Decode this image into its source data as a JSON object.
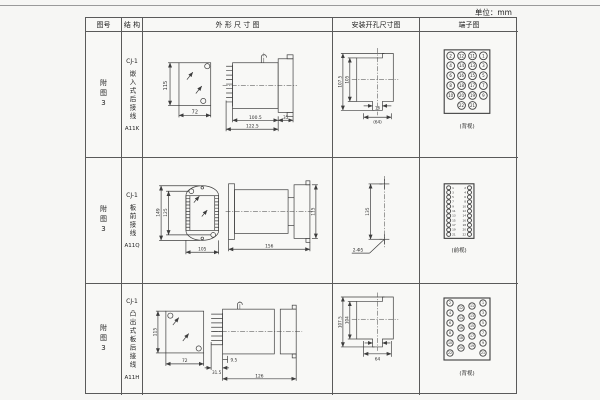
{
  "page": {
    "unit_label": "单位：mm"
  },
  "table": {
    "headers": {
      "fig_no": "图号",
      "structure": "结 构",
      "outline": "外 形 尺 寸 图",
      "mounting": "安装开孔尺寸图",
      "terminal": "端子图"
    }
  },
  "rows": [
    {
      "fig_no": "附图3",
      "model": "CJ-1",
      "mount_type": "嵌入式后接线",
      "code": "A11K",
      "outline": {
        "front_h": "115",
        "front_w": "72",
        "len1": "100.5",
        "len2": "122.5",
        "len3": "35"
      },
      "mounting": {
        "v_outer": "107.5",
        "v_inner": "105",
        "slot_w": "16",
        "span": "(64)"
      },
      "terminal": {
        "view": "(背视)",
        "rows": [
          [
            2,
            12,
            11,
            1
          ],
          [
            4,
            14,
            13,
            3
          ],
          [
            6,
            16,
            15,
            5
          ],
          [
            8,
            18,
            17,
            7
          ],
          [
            10,
            20,
            19,
            9
          ],
          [
            22,
            21
          ]
        ]
      }
    },
    {
      "fig_no": "附图3",
      "model": "CJ-1",
      "mount_type": "板前接线",
      "code": "A11Q",
      "outline": {
        "front_h_outer": "149",
        "front_h_inner": "125",
        "front_w": "105",
        "side_len": "156",
        "side_h": "115"
      },
      "mounting": {
        "hole_spacing": "135",
        "hole_note": "2-Φ5"
      },
      "terminal": {
        "view": "(前视)",
        "pairs": [
          [
            1,
            2
          ],
          [
            3,
            4
          ],
          [
            5,
            6
          ],
          [
            7,
            8
          ],
          [
            9,
            10
          ],
          [
            11,
            12
          ],
          [
            13,
            14
          ],
          [
            15,
            16
          ],
          [
            17,
            18
          ],
          [
            19,
            20
          ],
          [
            21,
            22
          ]
        ]
      }
    },
    {
      "fig_no": "附图3",
      "model": "CJ-1",
      "mount_type": "凸出式板后接线",
      "code": "A11H",
      "outline": {
        "front_h": "115",
        "front_w": "72",
        "pin_len": "31.5",
        "offset": "9.5",
        "body_len": "126"
      },
      "mounting": {
        "v_outer": "107.5",
        "v_inner": "104",
        "span": "64"
      },
      "terminal": {
        "view": "(背视)",
        "cols": [
          [
            2,
            4,
            6,
            8,
            10,
            22
          ],
          [
            12,
            14,
            16,
            18,
            20
          ],
          [
            11,
            13,
            15,
            17,
            19
          ],
          [
            1,
            3,
            5,
            7,
            9,
            21
          ]
        ]
      }
    }
  ]
}
